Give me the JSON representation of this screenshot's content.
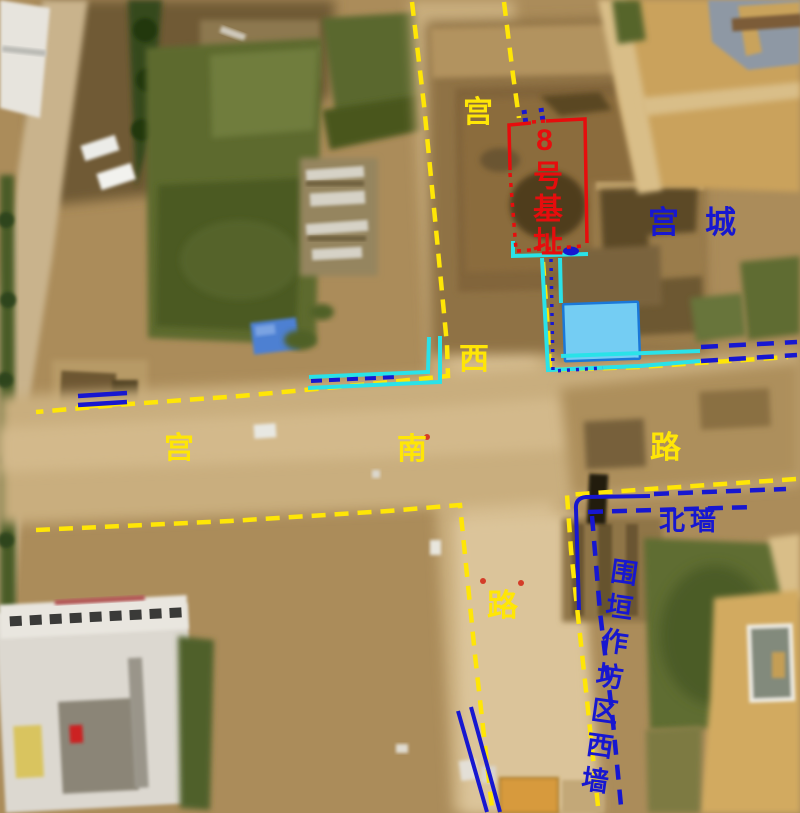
{
  "labels": {
    "foundation_site": "8号基址",
    "palace_city": "宫城",
    "north_wall": "北墙",
    "workshop_area_west_wall": "围垣作坊区西墙",
    "road_west": {
      "chars": [
        "宫",
        "西",
        "路"
      ]
    },
    "road_south": {
      "chars": [
        "宫",
        "南",
        "路"
      ]
    }
  },
  "colors": {
    "road_yellow": "#ffe606",
    "red": "#e60d0d",
    "blue": "#1717d0",
    "cyan": "#2ae2e8",
    "pond_fill": "#74cdf3",
    "pond_border": "#1a78d8"
  }
}
